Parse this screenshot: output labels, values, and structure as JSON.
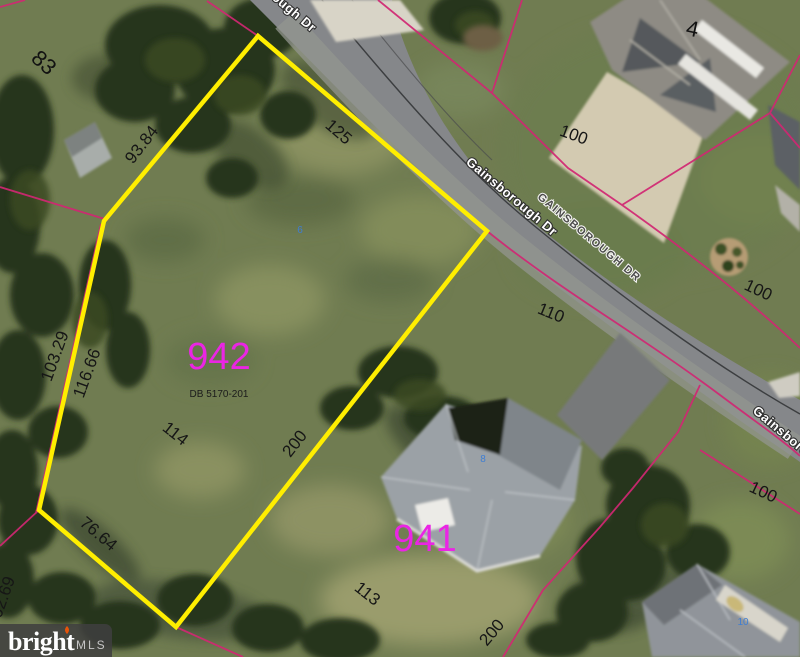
{
  "map_type": "aerial-parcel-map",
  "watermark": {
    "brand": "bright",
    "suffix": "MLS"
  },
  "streets": {
    "top": "Gainsborough Dr",
    "mid": "Gainsborough Dr",
    "surface": "GAINSBOROUGH DR",
    "bottom_right": "Gainsborough Dr"
  },
  "parcels": {
    "highlighted": {
      "number": "942",
      "deed_ref": "DB 5170-201",
      "frontage": "125",
      "side_right": "200",
      "side_upper_left": "93.84",
      "side_left_outer": "103.29",
      "side_left_inner": "116.66",
      "rear": "76.64",
      "interior_width": "114"
    },
    "neighbor_numbers": {
      "left": "83",
      "below": "941",
      "upper_right": "4"
    },
    "dimensions": {
      "dim_110": "110",
      "dim_100_top": "100",
      "dim_100_mid": "100",
      "dim_100_lower": "100",
      "dim_113": "113",
      "dim_200_bottom": "200",
      "dim_102_69_partial": "02.69"
    }
  },
  "house_numbers": {
    "h6": "6",
    "h8": "8",
    "h10": "10"
  },
  "colors": {
    "parcel_highlight": "#ffee00",
    "parcel_boundary": "#d12773",
    "parcel_number_text": "#ea25e4",
    "house_number_text": "#3f7ed2",
    "road": "#85878a",
    "grass": "#707c51"
  }
}
